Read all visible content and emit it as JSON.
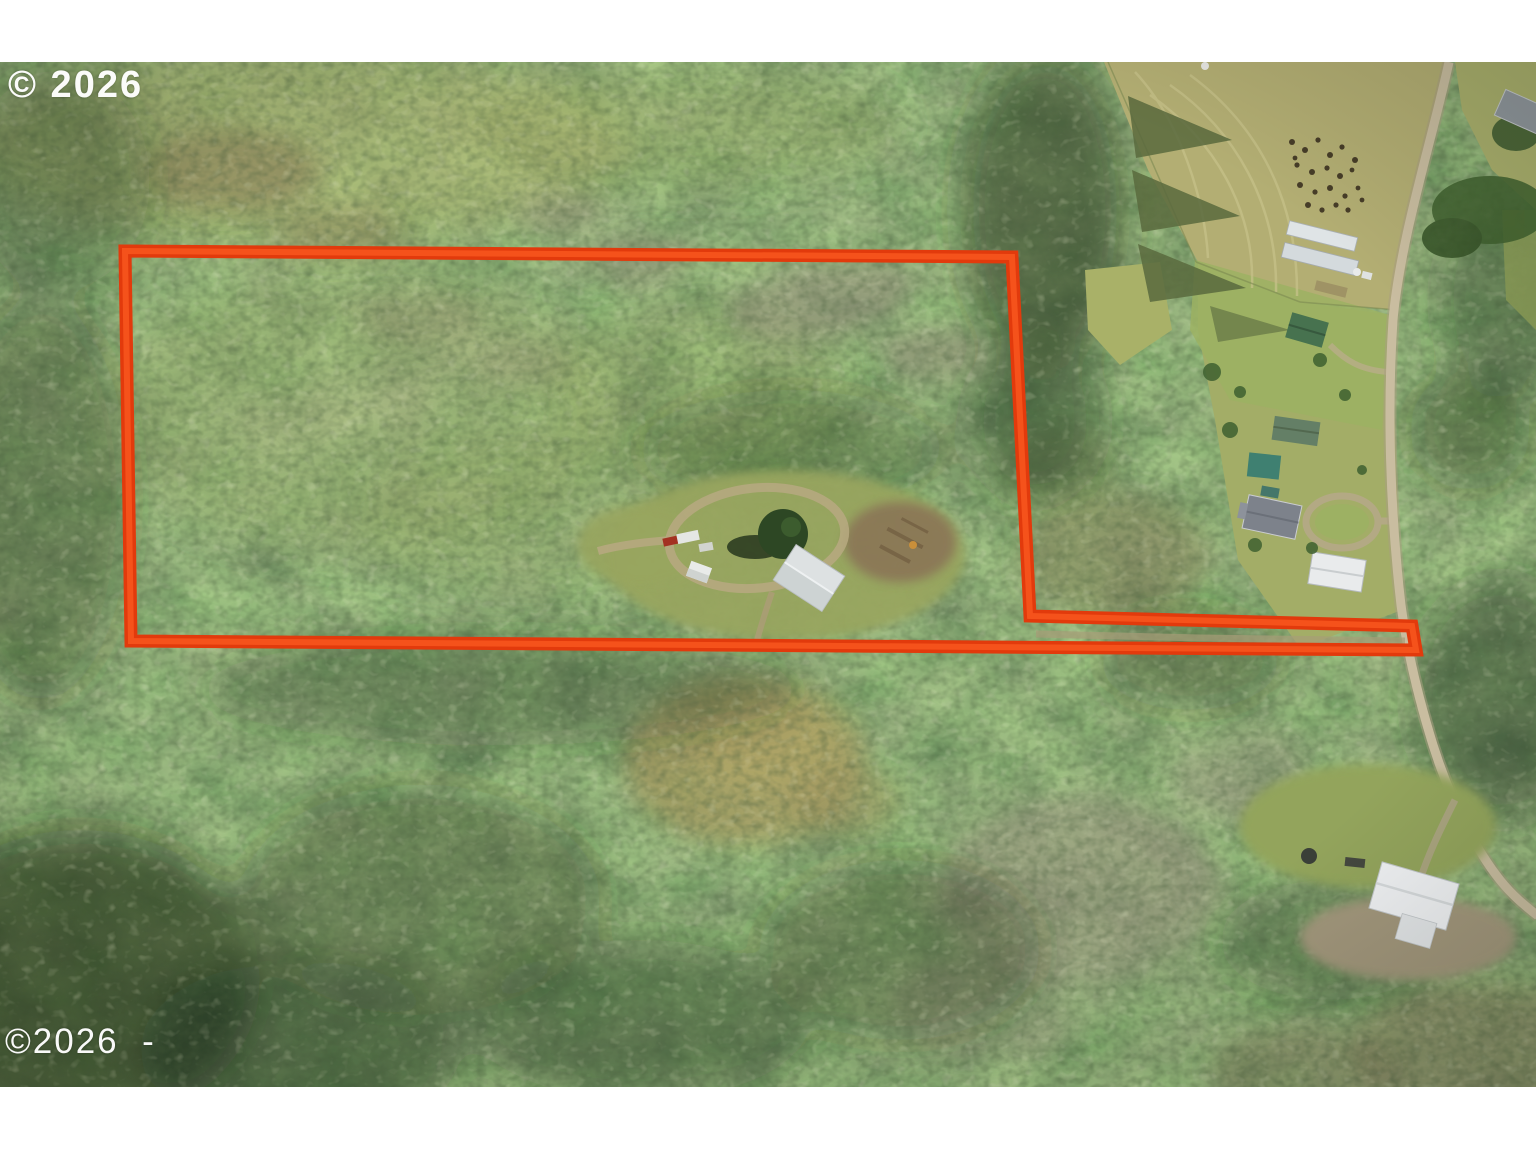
{
  "meta": {
    "type": "aerial-drone-photograph",
    "description": "Aerial view of a forested rural parcel outlined in red, with an access strip running east to a country road, neighboring farms, pastures and a homestead along the road",
    "width": 1536,
    "height": 1152
  },
  "photo": {
    "frame_background": "#ffffff",
    "top_margin_px": 62,
    "bottom_margin_px": 65
  },
  "watermarks": {
    "top_left": "© 2026",
    "bottom_left": "©2026  -",
    "color": "#ffffff"
  },
  "boundary": {
    "color": "#e23a0c",
    "highlight_color": "#f8571e",
    "stroke_width": 13,
    "shape": "rectangular wooded parcel with a narrow panhandle strip extending east to the road"
  },
  "palette": {
    "forest_green": "#47702f",
    "young_forest": "#aab269",
    "dark_conifer": "#24371e",
    "bare_trees_gray": "#9b917f",
    "pasture_olive": "#b3ae73",
    "farm_lawn": "#a3ad67",
    "meadow_tan": "#a79a60",
    "road_tan": "#c9bda0",
    "dirt_brown": "#8a7656",
    "building_white": "#e9ebec",
    "barn_green": "#47724f",
    "barn_teal": "#3f8071",
    "truck_red": "#a33222"
  }
}
